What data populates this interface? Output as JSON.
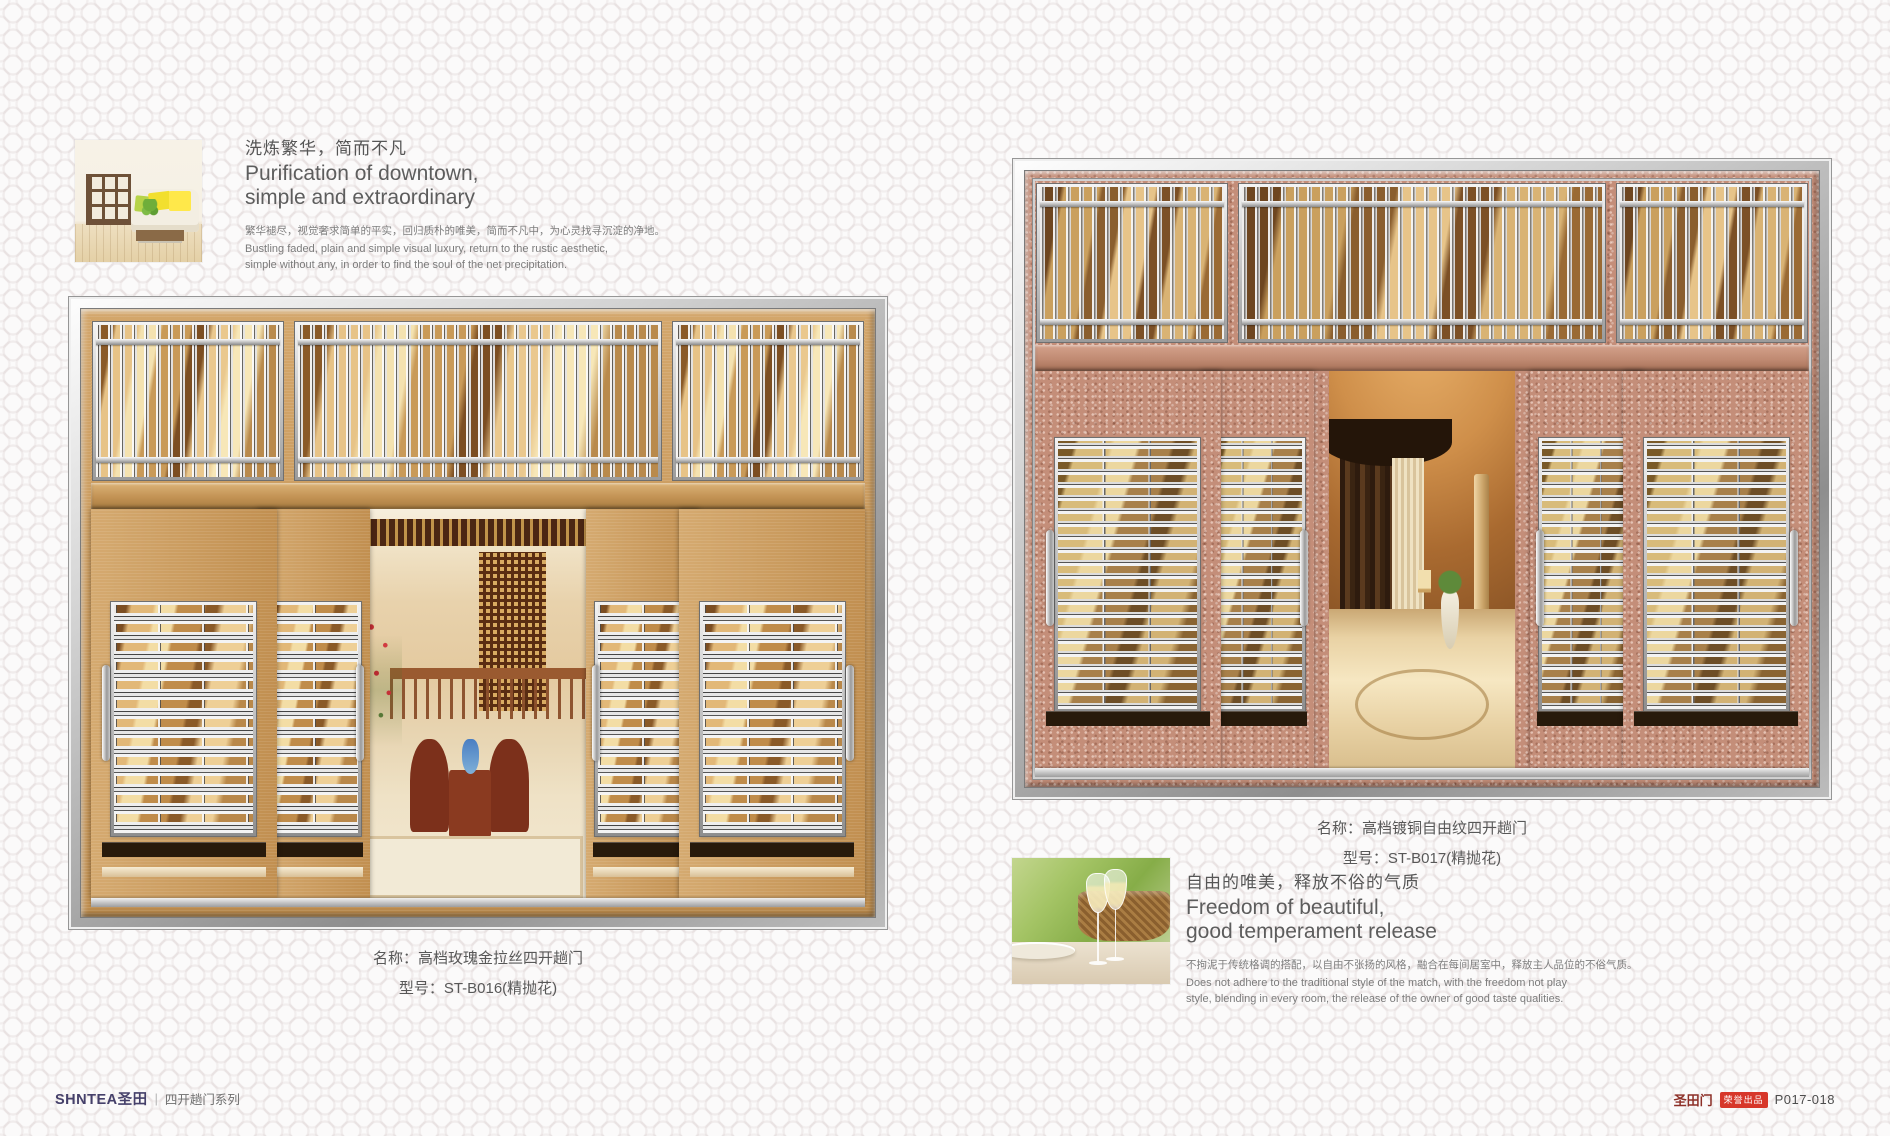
{
  "page": {
    "background": "#fbfafa",
    "pattern_color": "#e9e2e2"
  },
  "left_block": {
    "heading_cn": "洗炼繁华，简而不凡",
    "heading_en_1": "Purification of downtown,",
    "heading_en_2": "simple and extraordinary",
    "body_cn": "繁华褪尽，视觉奢求简单的平实，回归质朴的唯美，简而不凡中，为心灵找寻沉淀的净地。",
    "body_en_1": "Bustling faded, plain and simple visual luxury, return to the rustic aesthetic,",
    "body_en_2": "simple without any, in order to find the soul of the net precipitation."
  },
  "left_door": {
    "caption_name": "名称：高档玫瑰金拉丝四开趟门",
    "caption_model": "型号：ST-B016(精抛花)",
    "finish_color": "#c89a5f",
    "metal_color": "#d8d8d8"
  },
  "right_door": {
    "caption_name": "名称：高档镀铜自由纹四开趟门",
    "caption_model": "型号：ST-B017(精抛花)",
    "finish_color": "#c28f7a",
    "metal_color": "#d8d8d8"
  },
  "right_block": {
    "heading_cn": "自由的唯美，释放不俗的气质",
    "heading_en_1": "Freedom of beautiful,",
    "heading_en_2": "good temperament release",
    "body_cn": "不拘泥于传统格调的搭配，以自由不张扬的风格，融合在每间居室中，释放主人品位的不俗气质。",
    "body_en_1": "Does not adhere to the traditional style of the match, with the freedom not play",
    "body_en_2": "style, blending in every room, the release of the owner of good taste qualities."
  },
  "footer": {
    "brand_logo": "SHNTEA圣田",
    "separator": "|",
    "series_label": "四开趟门系列",
    "brand_right": "圣田门",
    "badge_label": "荣誉出品",
    "page_number": "P017-018",
    "logo_color": "#45406a",
    "badge_color": "#d7372a"
  }
}
